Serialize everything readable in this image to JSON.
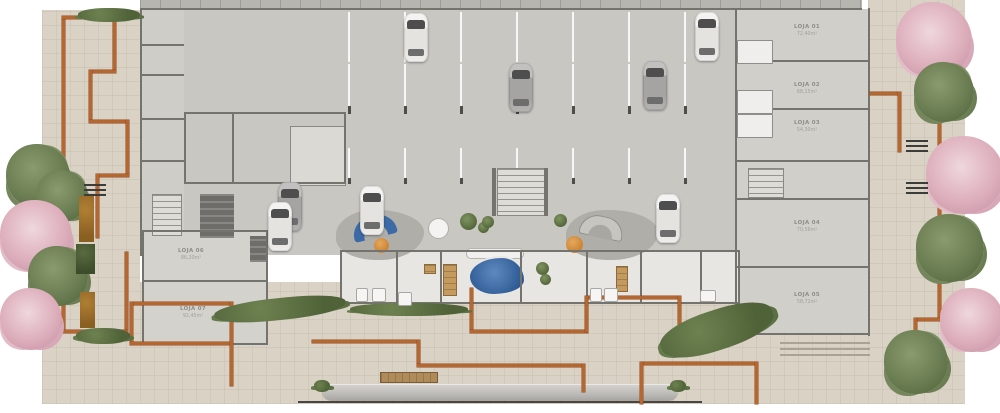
{
  "plan": {
    "type": "residential-commercial ground floor plan render",
    "background": "#ffffff"
  },
  "palette": {
    "paving_beige": "#d9d2c5",
    "terracotta_path": "#b5672f",
    "garage_floor": "#c9c7c2",
    "shop_floor": "#d1cfca",
    "room_floor": "#e8e6e2",
    "wall": "#75736e",
    "water_blue": "#35629c",
    "sofa_blue": "#3c6aa6",
    "accent_orange": "#d98f3f",
    "wood_tan": "#c49a5e",
    "hedge_green": "#5f7446",
    "tree_green": "#76875c",
    "tree_pink": "#ddaebc",
    "car_white": "#f1f0ee",
    "car_silver": "#b0afad"
  },
  "units": [
    {
      "name": "LOJA 01",
      "area": "72,40m²"
    },
    {
      "name": "LOJA 02",
      "area": "68,15m²"
    },
    {
      "name": "LOJA 03",
      "area": "54,30m²"
    },
    {
      "name": "LOJA 04",
      "area": "70,56m²"
    },
    {
      "name": "LOJA 05",
      "area": "58,72m²"
    },
    {
      "name": "LOJA 06",
      "area": "86,20m²"
    },
    {
      "name": "LOJA 07",
      "area": "92,45m²"
    }
  ]
}
